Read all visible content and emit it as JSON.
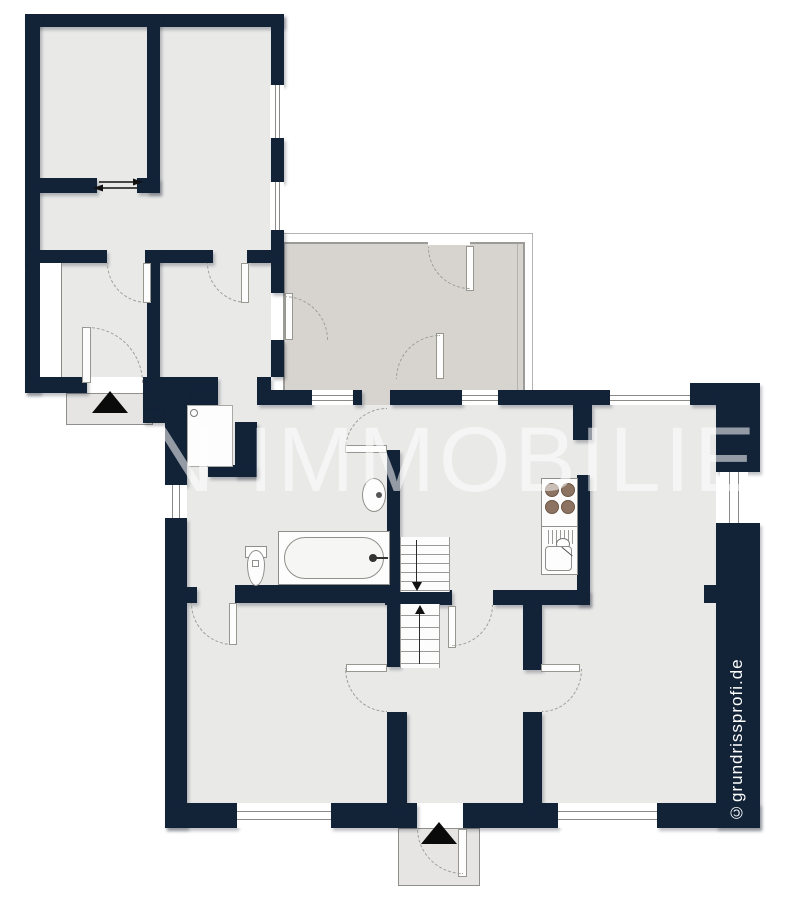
{
  "document": {
    "type": "floor-plan",
    "style": "2D architectural plan, dark navy walls"
  },
  "watermark": {
    "text": "N IMMOBILIEN"
  },
  "copyright": {
    "text": "©grundrissprofi.de"
  },
  "colors": {
    "wall": "#122338",
    "room_fill": "#e9e9e8",
    "annex_fill": "#d7d4d0",
    "porch_fill": "#e6e5e3",
    "fixture_line": "#8a8a86",
    "burner": "#8d7361",
    "entrance_arrow": "#0a0a0a",
    "watermark": "rgba(255,255,255,0.55)",
    "background": "#ffffff"
  },
  "icons": {
    "fixtures": [
      "bathtub",
      "toilet",
      "wash-basin",
      "shower-tray",
      "boiler-circle",
      "kitchen-stove-with-sink",
      "stairs-flight-down",
      "stairs-flight-up",
      "entrance-arrow-triangle",
      "sliding-door-arrow",
      "door-swing-arc",
      "door-leaf",
      "window"
    ]
  }
}
